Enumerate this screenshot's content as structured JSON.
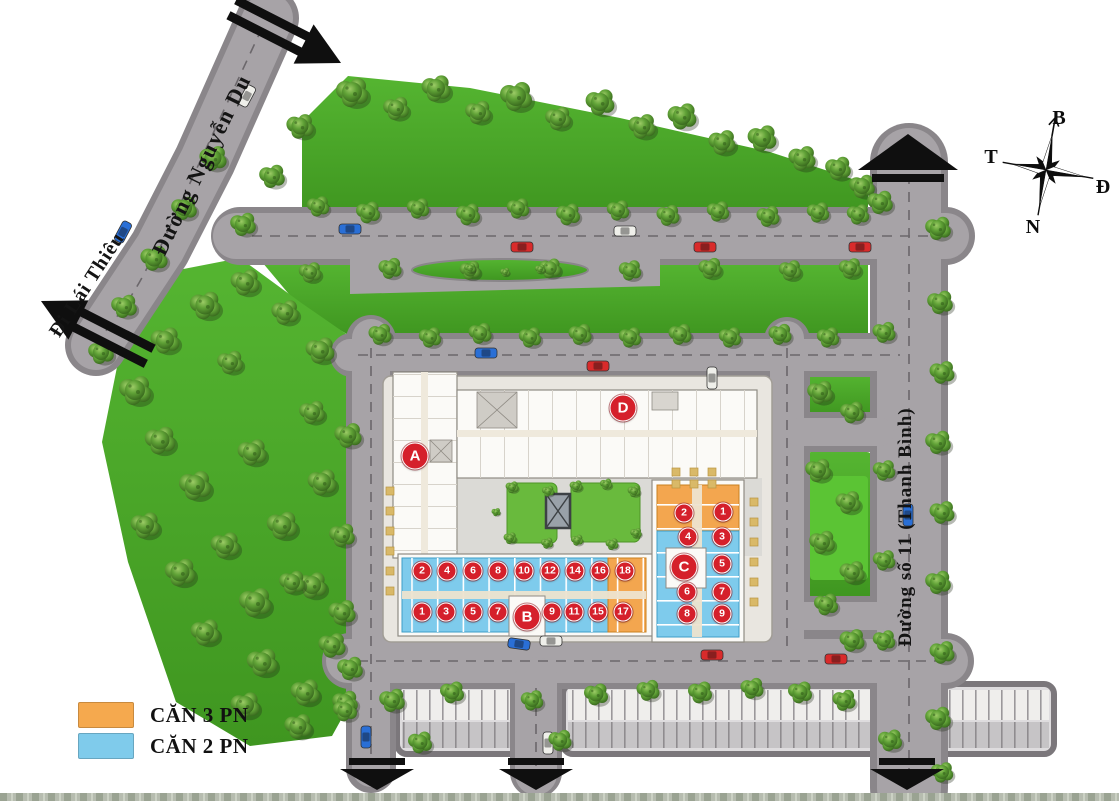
{
  "map": {
    "road_labels": {
      "nguyen_du": "Đường Nguyễn Du",
      "lai_thieu": "Đi Lái Thiêu",
      "street_11": "Đường số 11 (Thanh Bình)"
    },
    "compass": {
      "north_label": "B",
      "east_label": "Đ",
      "south_label": "N",
      "west_label": "T"
    },
    "legend": {
      "items": [
        {
          "label": "CĂN 3 PN",
          "color": "#F5A94E"
        },
        {
          "label": "CĂN 2 PN",
          "color": "#7FCBEB"
        }
      ]
    },
    "blocks": [
      "A",
      "B",
      "C",
      "D"
    ],
    "units": {
      "block_b_top_row": [
        "2",
        "4",
        "6",
        "8",
        "10",
        "12",
        "14",
        "16",
        "18"
      ],
      "block_b_bottom_row": [
        "1",
        "3",
        "5",
        "7",
        "9",
        "11",
        "15",
        "17"
      ],
      "block_c": [
        "1",
        "2",
        "3",
        "4",
        "5",
        "6",
        "7",
        "8",
        "9"
      ],
      "orange_units": {
        "block_b": [
          "17",
          "18"
        ],
        "block_c": [
          "1",
          "2"
        ]
      }
    },
    "badge_color": "#D5202B"
  }
}
